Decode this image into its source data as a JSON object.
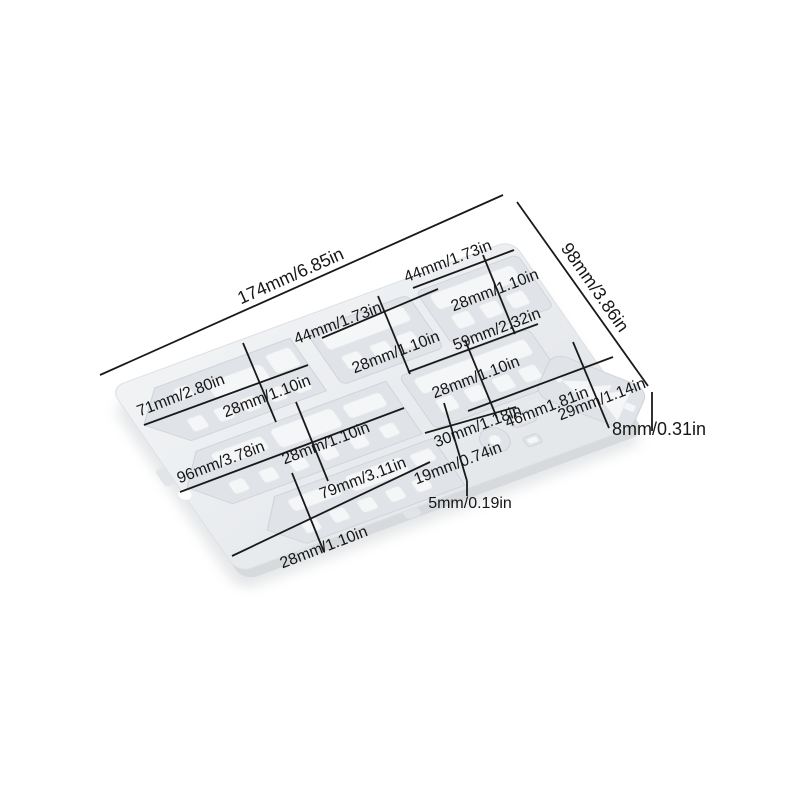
{
  "subject": "train-shaped silicone mold, tilted top view, with size annotations",
  "colors": {
    "background": "#ffffff",
    "mold_top": "#eef0f3",
    "mold_side": "#d6dadd",
    "cavity": "#e0e3e7",
    "raised_detail": "#f5f6f8",
    "dimension_line": "#1a1a1a",
    "text": "#161616"
  },
  "labels": {
    "overall_length": "174mm/6.85in",
    "overall_width": "98mm/3.86in",
    "thickness": "8mm/0.31in",
    "locomotive_length": "71mm/2.80in",
    "locomotive_height": "28mm/1.10in",
    "car1_length": "44mm/1.73in",
    "car1_height": "28mm/1.10in",
    "car2_length": "44mm/1.73in",
    "car2_height": "28mm/1.10in",
    "car3_length": "59mm/2.32in",
    "car3_height": "28mm/1.10in",
    "long_train_length": "96mm/3.78in",
    "long_train_height": "28mm/1.10in",
    "bottom_train_length": "79mm/3.11in",
    "bottom_train_height": "28mm/1.10in",
    "wheel_group_length": "30mm/1.18in",
    "wheel_group_height": "19mm/0.74in",
    "tree_length": "46mm1.81in",
    "tree_height": "29mm/1.14in",
    "small_piece_size": "5mm/0.19in"
  }
}
